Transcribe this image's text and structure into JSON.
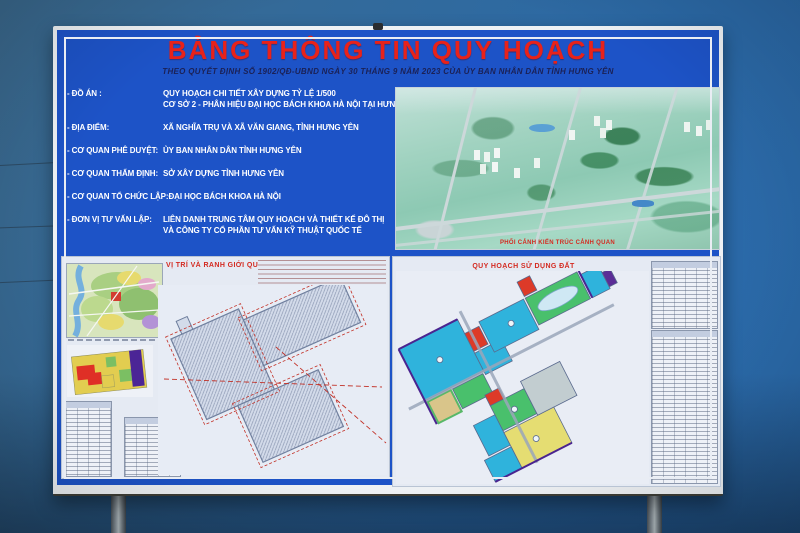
{
  "board": {
    "title": "BẢNG THÔNG TIN QUY HOẠCH",
    "subtitle": "THEO QUYẾT ĐỊNH SỐ 1902/QĐ-UBND NGÀY 30 THÁNG 9 NĂM 2023 CỦA ỦY BAN NHÂN DÂN TỈNH HƯNG YÊN",
    "info_rows": [
      {
        "label": "- ĐỒ ÁN :",
        "value": "QUY HOẠCH CHI TIẾT XÂY DỰNG TỶ LỆ 1/500",
        "value2": "CƠ SỞ 2 - PHÂN HIỆU ĐẠI HỌC BÁCH KHOA HÀ NỘI TẠI HƯNG YÊN"
      },
      {
        "label": "- ĐỊA ĐIỂM:",
        "value": "XÃ NGHĨA TRỤ VÀ XÃ VĂN GIANG, TỈNH HƯNG YÊN"
      },
      {
        "label": "- CƠ QUAN PHÊ DUYỆT:",
        "value": "ỦY BAN NHÂN DÂN TỈNH HƯNG YÊN"
      },
      {
        "label": "- CƠ QUAN THẨM ĐỊNH:",
        "value": "SỞ XÂY DỰNG TỈNH HƯNG YÊN"
      },
      {
        "label": "- CƠ QUAN TỔ CHỨC LẬP:",
        "value": "ĐẠI HỌC BÁCH KHOA HÀ NỘI"
      },
      {
        "label": "- ĐƠN VỊ TƯ VẤN LẬP:",
        "value": "LIÊN DANH TRUNG TÂM QUY HOẠCH VÀ THIẾT KẾ ĐÔ THỊ",
        "value2": "VÀ CÔNG TY CỔ PHẦN TƯ VẤN KỸ THUẬT QUỐC TẾ"
      }
    ],
    "render_caption": "PHỐI CẢNH KIẾN TRÚC CẢNH QUAN",
    "panel_left_title": "VỊ TRÍ VÀ RANH GIỚI QUY HOẠCH",
    "panel_right_title": "QUY HOẠCH SỬ DỤNG ĐẤT",
    "colors": {
      "board_blue": "#1d53c7",
      "title_red": "#e8221a",
      "info_text": "#ffffff",
      "panel_bg": "#e5eaf3",
      "landuse_cyan": "#2fb3dc",
      "landuse_green": "#49c06c",
      "landuse_red": "#dd3a28",
      "landuse_yellow": "#e5dd72",
      "sky_blue": "#2b69a6"
    }
  }
}
